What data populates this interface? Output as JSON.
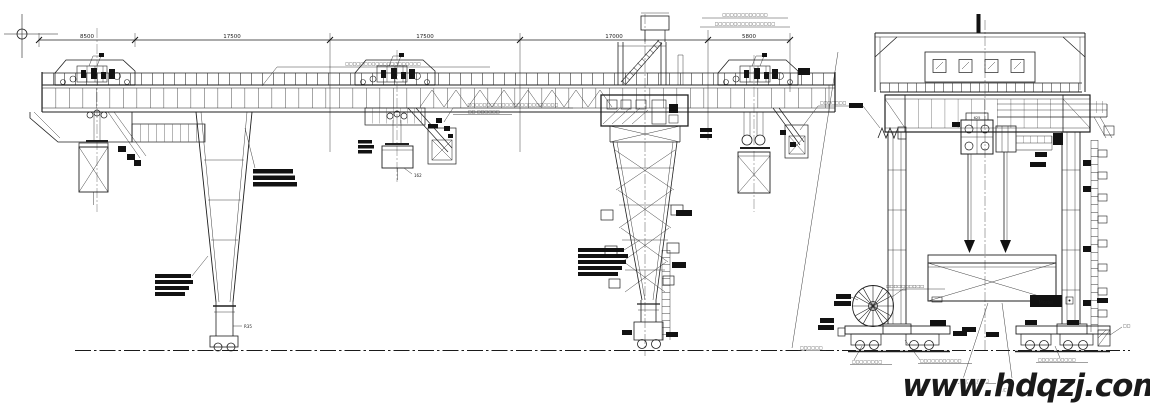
{
  "drawing": {
    "type": "gantry-crane-general-arrangement",
    "views": {
      "left": "elevation",
      "right": "end-view"
    }
  },
  "dimensions": {
    "d1": "8500",
    "d2": "17500",
    "d3": "17500",
    "d4": "17000",
    "d5": "5800"
  },
  "labels": {
    "trolley_load_mark": "162",
    "leg_bottom_mark": "R35",
    "hoist_block_mark": "625",
    "model_tag": "Model",
    "right_jack_mark": "□□"
  },
  "notes": {
    "top_right_1": "□□□□□□□□□□□□",
    "top_right_2": "□□□□□□□□□□□□□□□□",
    "girder_note": "□□□□□□□□□□□□□□□□□□□□",
    "mid_note_1": "□□□□□□□□□□□□□□□□□□□□□□□□",
    "mid_note_2": "□□-□□□□□□",
    "right_trolley_note": "□□□□□□□",
    "reel_note": "□□□□□□□□□□",
    "bogie_left_note": "□□□□□□□□",
    "bogie_left_note2": "□□□□□□",
    "bogie_center_note": "□□□□□□□□□□□",
    "bogie_center_note2": "□□□□□□□□□",
    "bogie_right_note": "□□□□□□□□□□",
    "endview_left_mark": "□□□"
  },
  "watermark": {
    "text": "www.hdqzj.com",
    "color": "#1e3fd6"
  }
}
